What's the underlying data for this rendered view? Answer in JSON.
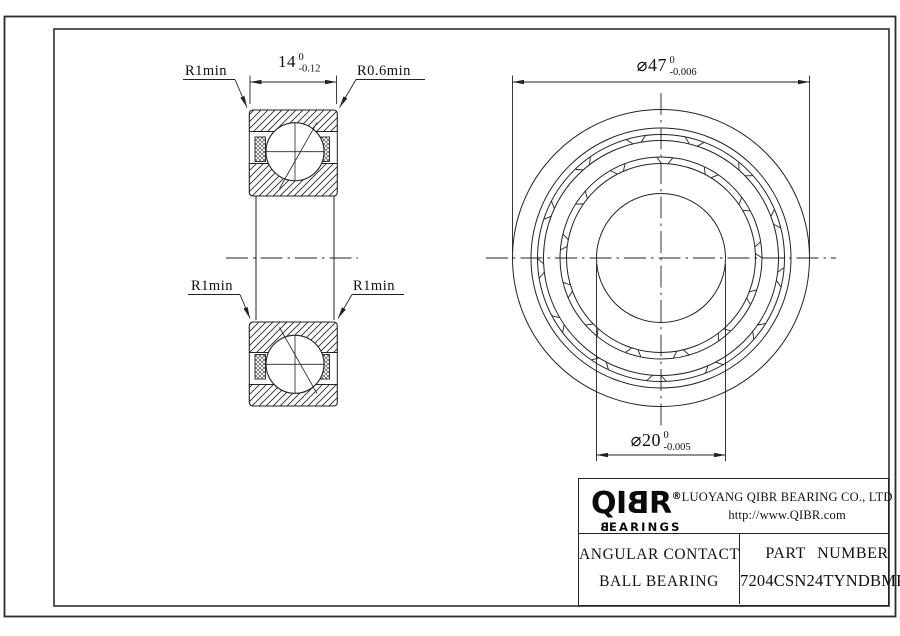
{
  "colors": {
    "line": "#222222",
    "text": "#111111",
    "background": "#ffffff"
  },
  "drawing": {
    "labels": {
      "r1min_top": "R1min",
      "r06min_top": "R0.6min",
      "r1min_mid_left": "R1min",
      "r1min_mid_right": "R1min"
    },
    "dimensions": {
      "width": {
        "value": "14",
        "tol_upper": "0",
        "tol_lower": "-0.12"
      },
      "outer_diameter": {
        "value": "⌀47",
        "tol_upper": "0",
        "tol_lower": "-0.006"
      },
      "bore_diameter": {
        "value": "⌀20",
        "tol_upper": "0",
        "tol_lower": "-0.005"
      }
    }
  },
  "title_block": {
    "logo": {
      "pre": "QI",
      "b": "B",
      "post": "R",
      "reg": "®",
      "sub_b": "B",
      "sub_rest": "EARINGS"
    },
    "company_name": "LUOYANG QIBR BEARING CO., LTD",
    "company_url": "http://www.QIBR.com",
    "product_line1": "ANGULAR CONTACT",
    "product_line2": "BALL BEARING",
    "part_label": "PART NUMBER",
    "part_number": "7204CSN24TYNDBMP4"
  }
}
